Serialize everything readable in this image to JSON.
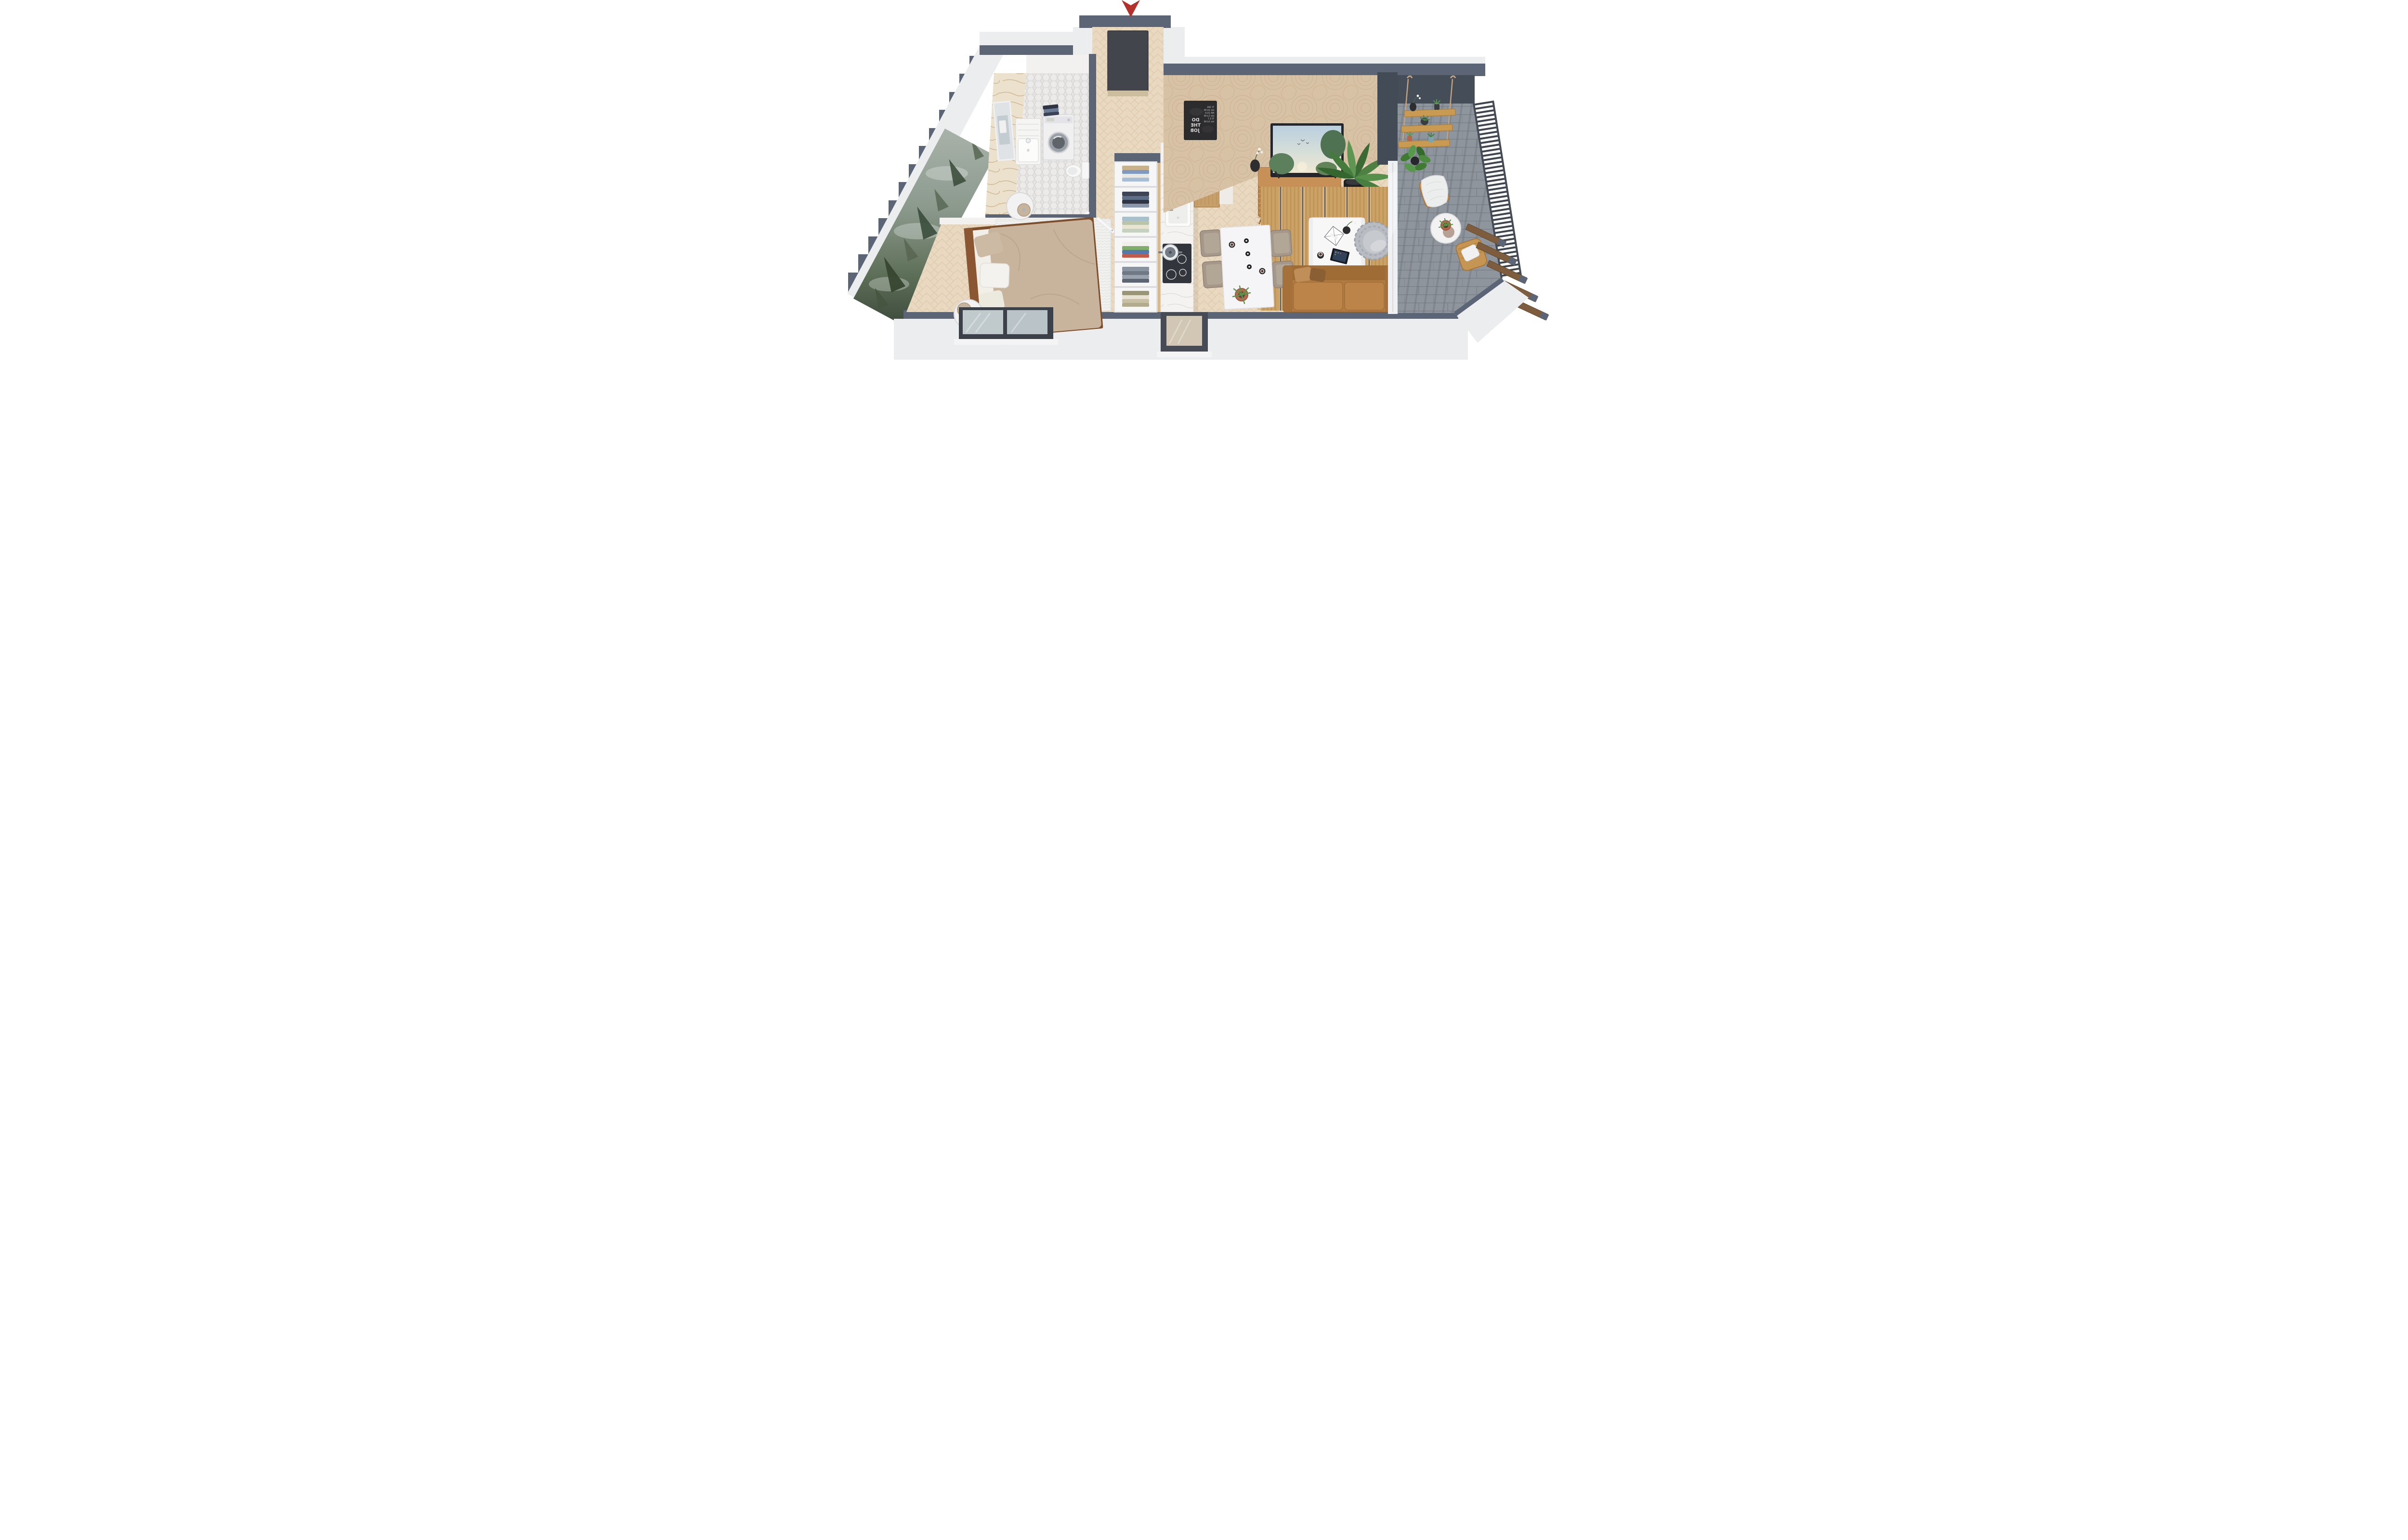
{
  "scene": {
    "title": "3D axonometric apartment floor-plan rendering",
    "entrance_marker": {
      "shape": "downward red arrow",
      "color": "#b3302b",
      "meaning": "entrance"
    },
    "rooms": [
      {
        "name": "Entry Hall",
        "floor": "light herringbone wood",
        "items": [
          "charcoal front door"
        ]
      },
      {
        "name": "Bathroom",
        "floor": "white hex mosaic tile",
        "wall": "beige marble panel",
        "items": [
          "wall mirror",
          "white vessel sink on slatted vanity",
          "front-loading washing machine",
          "folded laundry stack",
          "toilet",
          "white bathroom door"
        ]
      },
      {
        "name": "Bedroom",
        "floor": "light herringbone wood",
        "wall": "misty pine-forest mural",
        "items": [
          "double bed with dark wood frame",
          "beige duvet",
          "white and beige pillows",
          "white knit rug",
          "round marble side table x2",
          "beige drum table lamp x2",
          "white interior door",
          "picture window"
        ]
      },
      {
        "name": "Hall Closet",
        "items": [
          "open shelving, 6 cubbies of folded clothes"
        ]
      },
      {
        "name": "Kitchen",
        "items": [
          "white marble counter",
          "inset sink with faucet",
          "black induction cooktop",
          "cooking pot",
          "coffee machine and grinder",
          "tall wooden cabinet"
        ]
      },
      {
        "name": "Living / Dining",
        "floor": "light herringbone wood",
        "wall": "beige textured plaster",
        "items": [
          "black chalkboard art",
          "wooden TV sideboard",
          "flat-screen TV showing forest scene",
          "black vase with white orchid",
          "potted palm in black planter",
          "white dining table",
          "upholstered dining chair x4",
          "black candlestick x3",
          "espresso cup x2",
          "potted plant on table",
          "striped jute rug",
          "white waterfall coffee table",
          "glass terrarium",
          "tablet",
          "gray woven lounge chair",
          "camel fabric sofa",
          "picture window"
        ]
      },
      {
        "name": "Balcony",
        "floor": "gray stone tile",
        "wall": "charcoal",
        "items": [
          "rope-hung wood shelf x3",
          "small potted plants",
          "schefflera plant",
          "rattan armchair with white throw",
          "round bistro table",
          "potted plant on table",
          "rattan armchair with white pillow",
          "black metal railing",
          "wooden louver fins"
        ]
      }
    ]
  },
  "chalkboard": {
    "mirrored": true,
    "title_lines": [
      "DO",
      "THE",
      "JOB"
    ],
    "note_lines": [
      "TI  196",
      "klo 10.00",
      "MA  25.6",
      "klo 13.00",
      "TI  5.7",
      "klo 14.00"
    ]
  },
  "palette": {
    "wall_cap_slate": "#5b6575",
    "wall_charcoal": "#49515c",
    "exterior_white": "#ecedef",
    "wood_floor": "#ead9c1",
    "marble": "#f4f3f1",
    "plaster_wall": "#d8c2a5",
    "chalkboard": "#2c2b2d",
    "mural_green": "#4a5a4a",
    "sofa_camel": "#b07a42",
    "rug_jute": "#c9a265",
    "rug_navy": "#3e4a63",
    "tv_wood": "#b9804a",
    "rattan": "#c59554",
    "stone_floor": "#8f959c",
    "plant_green": "#4c7f46",
    "accent_red": "#b3302b"
  }
}
